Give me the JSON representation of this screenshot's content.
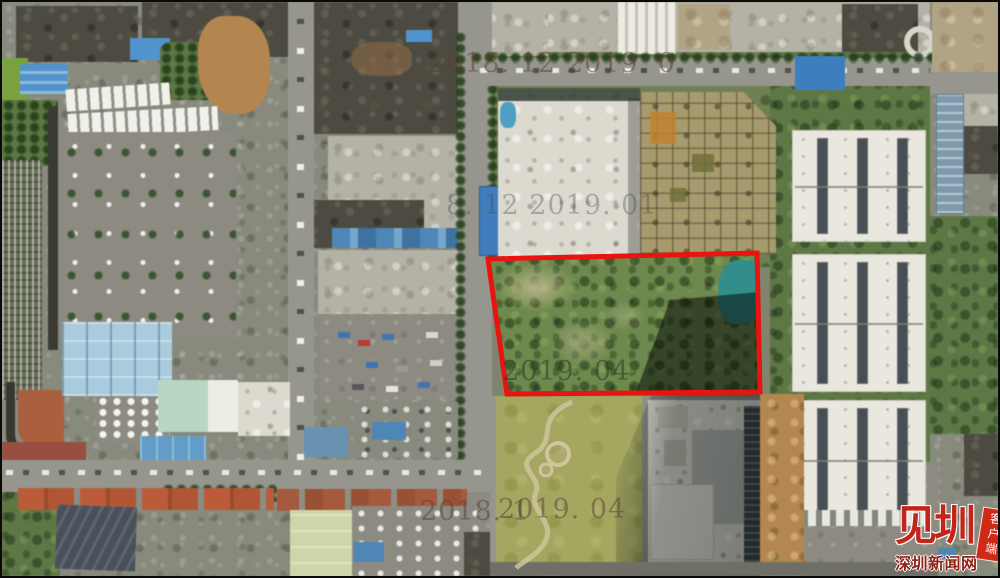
{
  "image": {
    "kind": "aerial-satellite-photo",
    "highlight": "land parcel outlined in red"
  },
  "watermarks": [
    {
      "text": "2018. 12  2019. 0"
    },
    {
      "text": "8. 12  2019. 01"
    },
    {
      "text": "2019. 04"
    },
    {
      "text": "2018. 1"
    },
    {
      "text": "2019. 04"
    }
  ],
  "logo": {
    "brand": "见圳",
    "site": "深圳新闻网",
    "tag": "客户端"
  },
  "colors": {
    "parcel_outline": "#e81410",
    "logo_red": "#c4251a",
    "pond": "#2e8f8c"
  }
}
